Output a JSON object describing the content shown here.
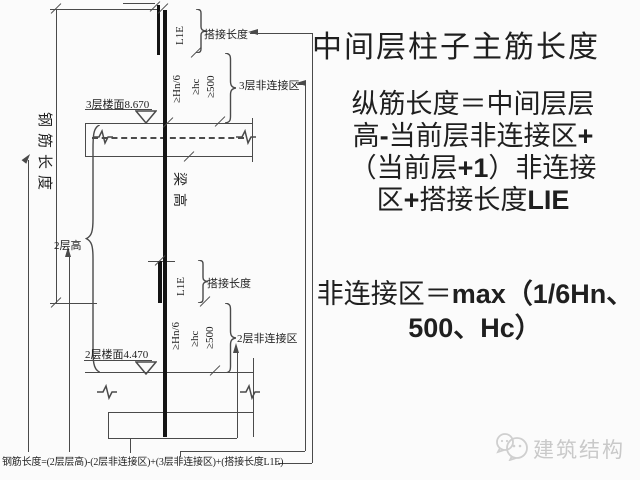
{
  "title": "中间层柱子主筋长度",
  "right_panel": {
    "formula_longitudinal": {
      "l1": "纵筋长度＝中间层层",
      "l2a": "高",
      "l2b": "-",
      "l2c": "当前层非连接区",
      "l2d": "+",
      "l3a": "（当前层",
      "l3b": "+1",
      "l3c": "）非连接",
      "l4a": "区",
      "l4b": "+",
      "l4c": "搭接长度",
      "l4d": "LIE"
    },
    "formula_nonconnect": {
      "l1a": "非连接区＝",
      "l1b": "max（1/6Hn、",
      "l2": "500、Hc）"
    }
  },
  "diagram": {
    "rebar_length_label": "钢筋长度",
    "story2_height_label": "2层高",
    "beam_height_label": "梁高",
    "floor3_level_label": "3层楼面8.670",
    "floor2_level_label": "2层楼面4.470",
    "lap_length_label_top": "搭接长度",
    "lap_length_label_mid": "搭接长度",
    "lap_code_top": "L1E",
    "lap_code_mid": "L1E",
    "hn6_top": "≥Hn/6",
    "hc_top": "≥hc",
    "v500_top": "≥500",
    "hn6_mid": "≥Hn/6",
    "hc_mid": "≥hc",
    "v500_mid": "≥500",
    "zone3_label": "3层非连接区",
    "zone2_label": "2层非连接区",
    "bottom_formula": "钢筋长度=(2层层高)-(2层非连接区)+(3层非连接区)+(搭接长度L1E)"
  },
  "watermark": {
    "brand": "建筑结构"
  },
  "colors": {
    "line": "#4a4a4a",
    "bar": "#141414",
    "text": "#1f1f1f",
    "watermark": "#c9c9c9",
    "background": "#fbfbfb"
  }
}
